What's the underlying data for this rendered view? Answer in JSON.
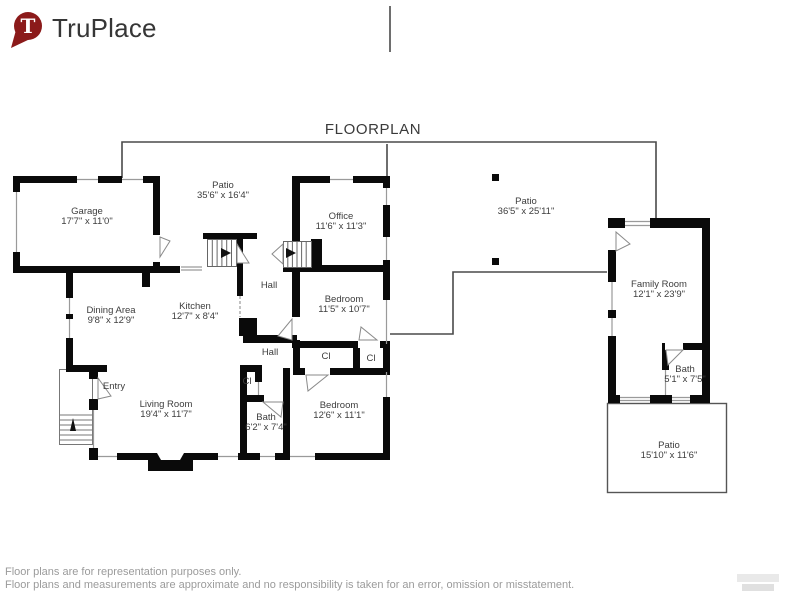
{
  "logo": {
    "text": "TruPlace",
    "mark": "T",
    "color": "#8b1a1a"
  },
  "title": "FLOORPLAN",
  "rooms": {
    "garage": {
      "name": "Garage",
      "dims": "17'7\" x 11'0\""
    },
    "patio_back": {
      "name": "Patio",
      "dims": "35'6\" x 16'4\""
    },
    "office": {
      "name": "Office",
      "dims": "11'6\" x 11'3\""
    },
    "patio_side": {
      "name": "Patio",
      "dims": "36'5\" x 25'11\""
    },
    "dining_area": {
      "name": "Dining Area",
      "dims": "9'8\" x 12'9\""
    },
    "kitchen": {
      "name": "Kitchen",
      "dims": "12'7\" x 8'4\""
    },
    "hall_upper": {
      "name": "Hall"
    },
    "bedroom_a": {
      "name": "Bedroom",
      "dims": "11'5\" x 10'7\""
    },
    "family_room": {
      "name": "Family Room",
      "dims": "12'1\" x 23'9\""
    },
    "entry": {
      "name": "Entry"
    },
    "living_room": {
      "name": "Living Room",
      "dims": "19'4\" x 11'7\""
    },
    "hall_lower": {
      "name": "Hall"
    },
    "closet_hall": {
      "name": "Cl"
    },
    "closet_a": {
      "name": "Cl"
    },
    "closet_b": {
      "name": "Cl"
    },
    "bath_main": {
      "name": "Bath",
      "dims": "6'2\" x 7'4\""
    },
    "bedroom_b": {
      "name": "Bedroom",
      "dims": "12'6\" x 11'1\""
    },
    "bath_family": {
      "name": "Bath",
      "dims": "5'1\" x 7'5\""
    },
    "patio_rear": {
      "name": "Patio",
      "dims": "15'10\" x 11'6\""
    }
  },
  "footer": {
    "line1": "Floor plans are for representation purposes only.",
    "line2": "Floor plans and measurements are approximate and no responsibility is taken for an error, omission or misstatement."
  },
  "colors": {
    "wall": "#0a0a0a",
    "boundary": "#4a4a4a",
    "label": "#3d3d3d",
    "muted": "#9b9b9b"
  }
}
